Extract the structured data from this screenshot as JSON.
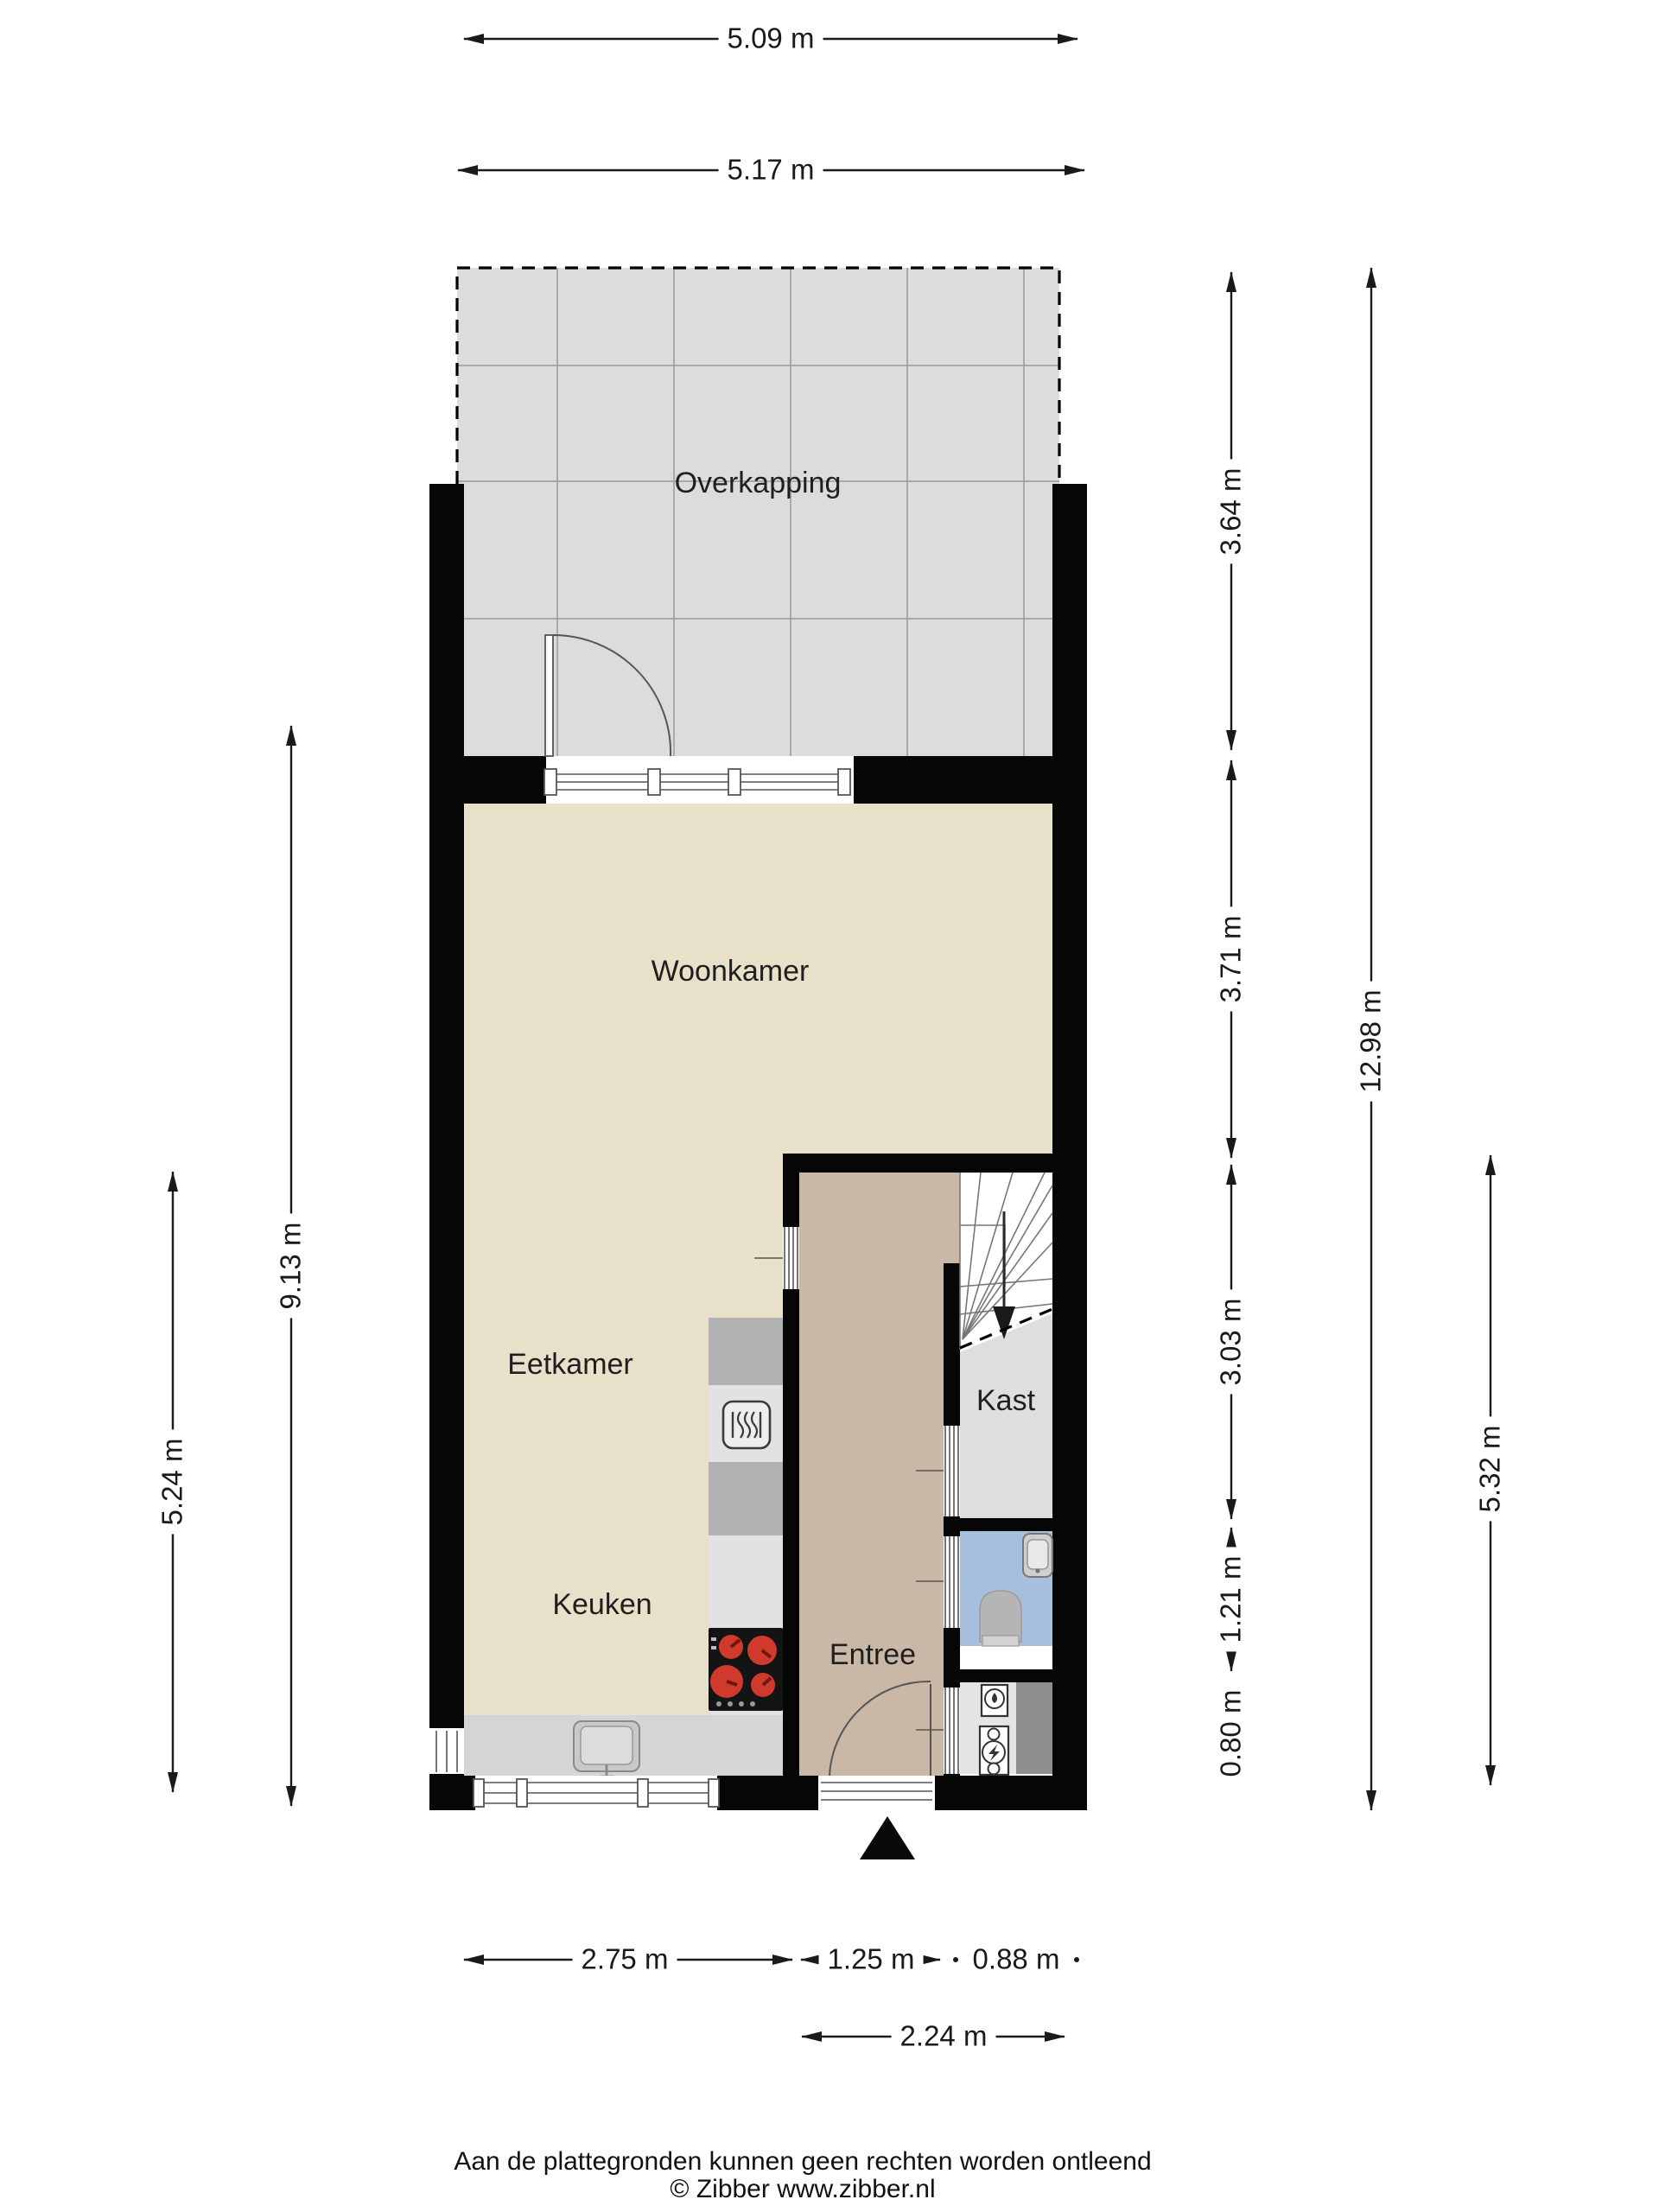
{
  "title": "Floor plan - begane grond",
  "rooms": {
    "overkapping": "Overkapping",
    "woonkamer": "Woonkamer",
    "eetkamer": "Eetkamer",
    "keuken": "Keuken",
    "entree": "Entree",
    "kast": "Kast"
  },
  "dimensions": {
    "top": [
      "5.09 m",
      "5.17 m"
    ],
    "left": [
      "9.13 m",
      "5.24 m"
    ],
    "right_sections": [
      "3.64 m",
      "3.71 m",
      "3.03 m",
      "1.21 m",
      "0.80 m"
    ],
    "right_total": "12.98 m",
    "right_lower": "5.32 m",
    "bottom": [
      "2.75 m",
      "1.25 m",
      "0.88 m"
    ],
    "bottom_total": "2.24 m"
  },
  "footer": {
    "disclaimer": "Aan de plattegronden kunnen geen rechten worden ontleend",
    "copyright": "© Zibber www.zibber.nl"
  },
  "icons": [
    "oven-icon",
    "cooktop-icon",
    "sink-icon",
    "washbasin-icon",
    "toilet-icon",
    "boiler-icon",
    "ventilation-unit-icon",
    "stairs-down-arrow-icon",
    "entrance-marker-icon",
    "door-swing-icon",
    "window-icon",
    "sliding-door-icon"
  ],
  "colors": {
    "wall": "#060606",
    "line": "#1a1a1a",
    "cream": "#e8e0c9",
    "tan": "#c8b8a5",
    "overkapping": "#dcdcdc",
    "kast": "#dedede",
    "bath": "#a6bfdc",
    "utility_light": "#e4e4e4",
    "utility_dark": "#8e8e8e",
    "counter_light": "#e2e2e2",
    "counter_dark": "#b2b2b2",
    "counter_strip": "#d5d5d5",
    "stove": "#141414",
    "burner": "#d03a2c"
  }
}
